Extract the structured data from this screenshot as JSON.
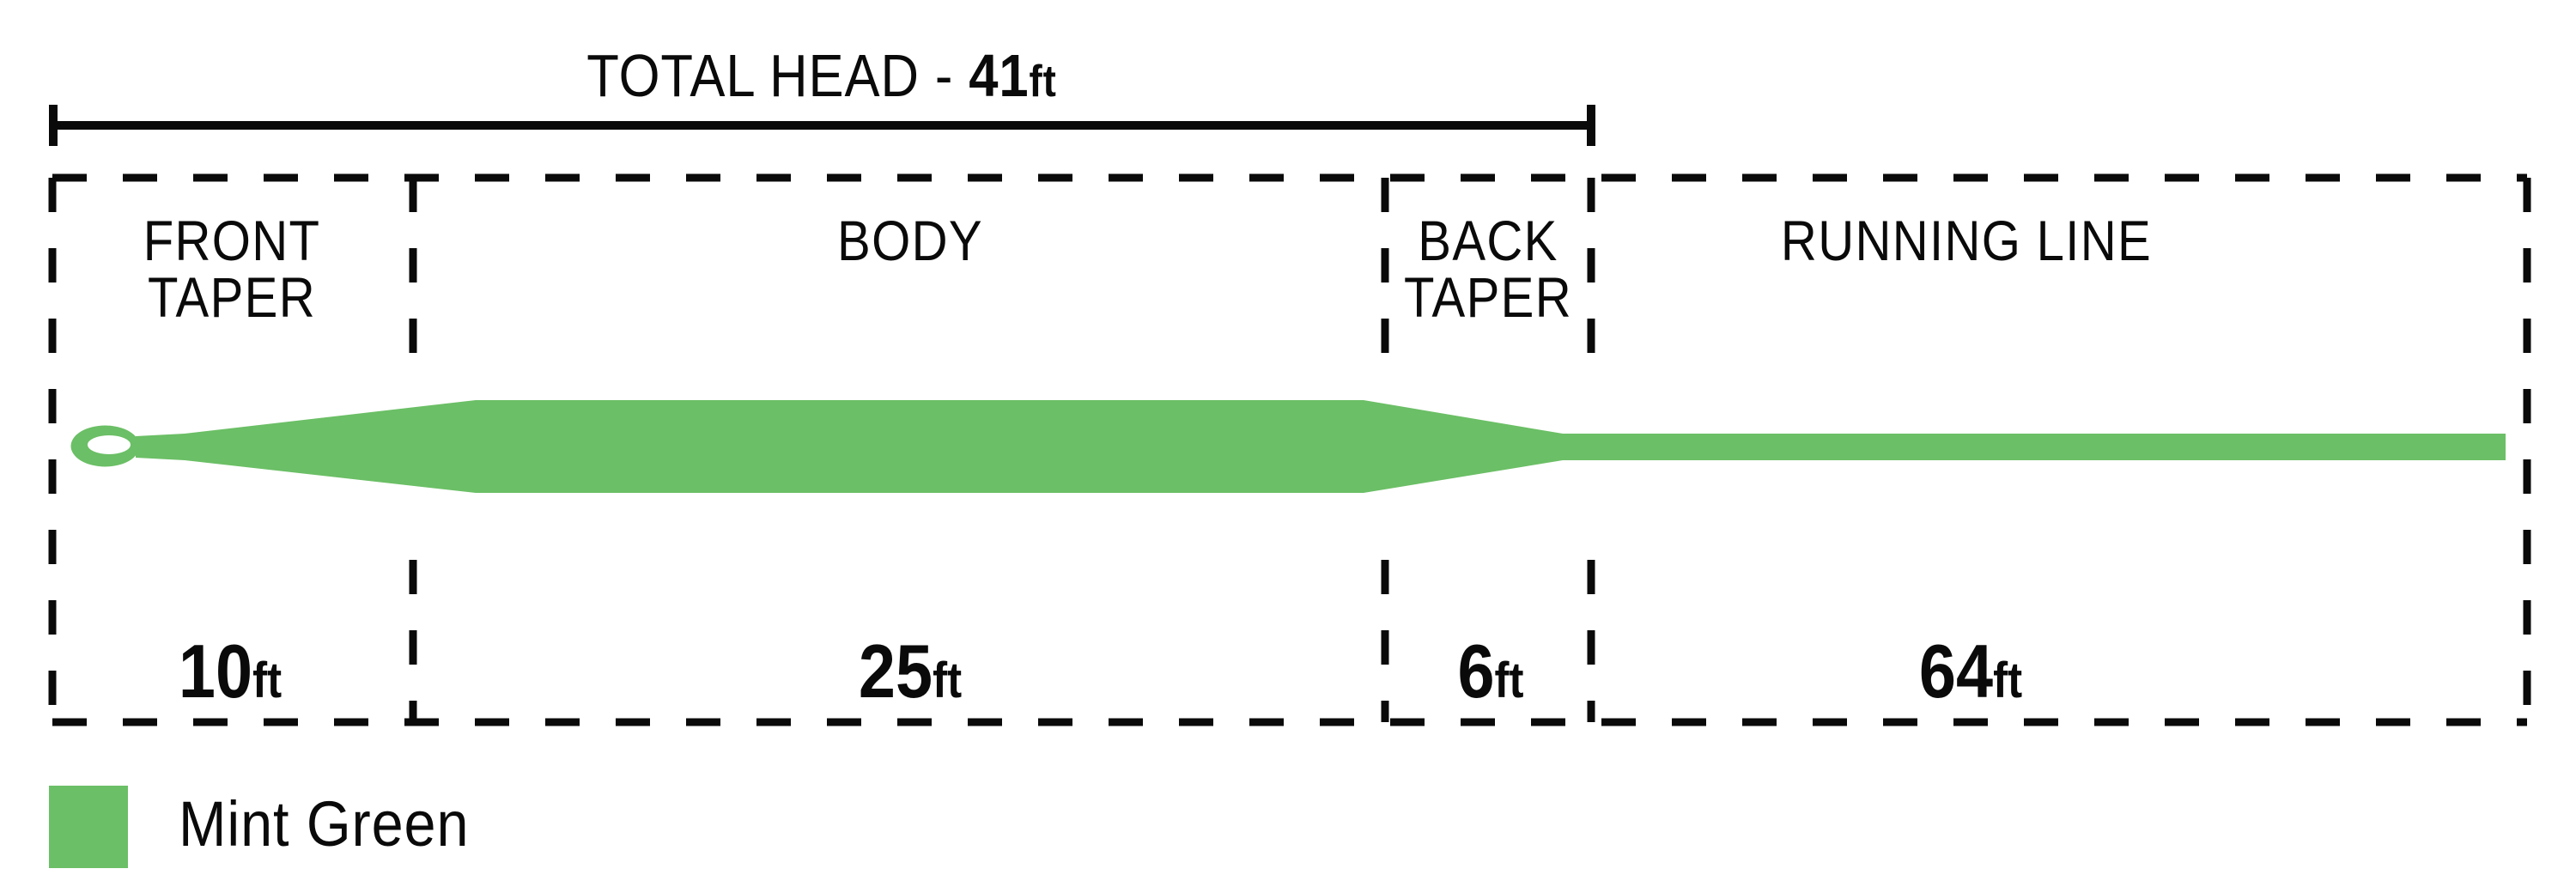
{
  "title": {
    "prefix": "TOTAL HEAD - ",
    "value": "41",
    "unit": "ft"
  },
  "sections": [
    {
      "id": "front-taper",
      "line1": "FRONT",
      "line2": "TAPER",
      "value": "10",
      "unit": "ft"
    },
    {
      "id": "body",
      "line1": "BODY",
      "line2": "",
      "value": "25",
      "unit": "ft"
    },
    {
      "id": "back-taper",
      "line1": "BACK",
      "line2": "TAPER",
      "value": "6",
      "unit": "ft"
    },
    {
      "id": "running-line",
      "line1": "RUNNING LINE",
      "line2": "",
      "value": "64",
      "unit": "ft"
    }
  ],
  "legend": {
    "label": "Mint Green",
    "color": "#6BBF66"
  },
  "colors": {
    "line": "#6BBF66",
    "ink": "#0a0a0a"
  }
}
